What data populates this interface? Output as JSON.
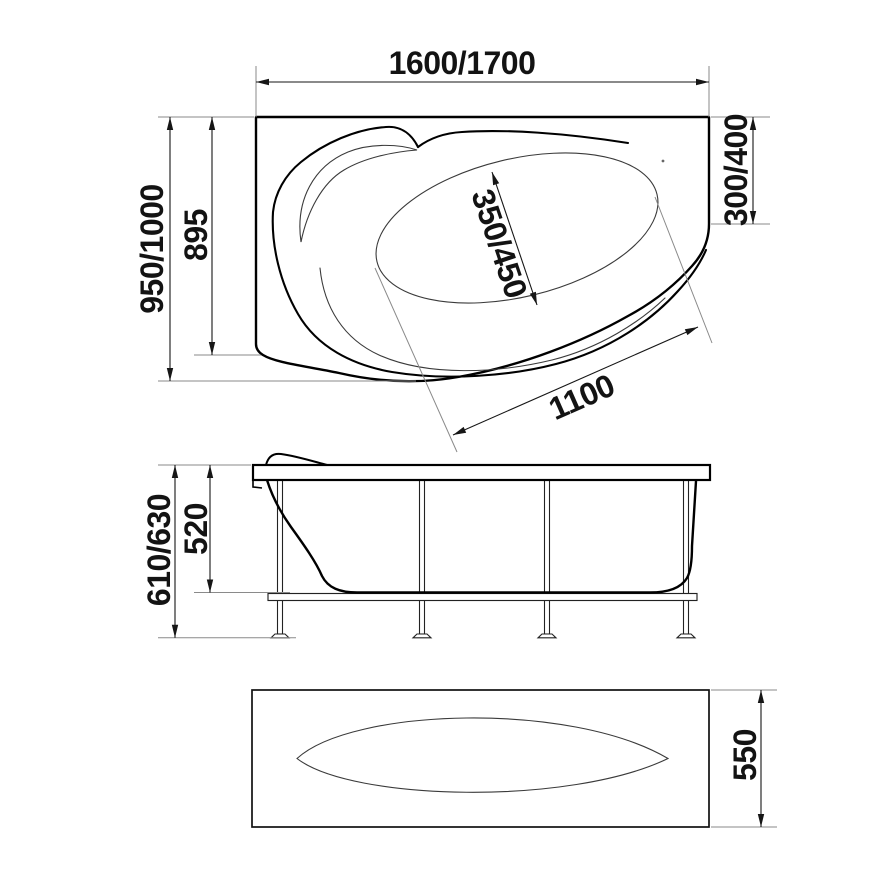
{
  "diagram": {
    "type": "technical-drawing",
    "subject": "Asymmetric corner bathtub with support frame, three orthographic views",
    "views": {
      "top": {
        "length": "1600/1700",
        "overall_width": "950/1000",
        "wall_side_width": "895",
        "short_side_depth": "300/400",
        "inner_well_width": "350/450",
        "inner_well_length": "1100"
      },
      "side": {
        "overall_height": "610/630",
        "shell_height": "520"
      },
      "front_panel": {
        "height": "550"
      }
    },
    "colors": {
      "background": "#ffffff",
      "outline": "#000000",
      "dimension_line": "#161616",
      "extension_line": "#8a8a8a",
      "text": "#131313"
    }
  }
}
